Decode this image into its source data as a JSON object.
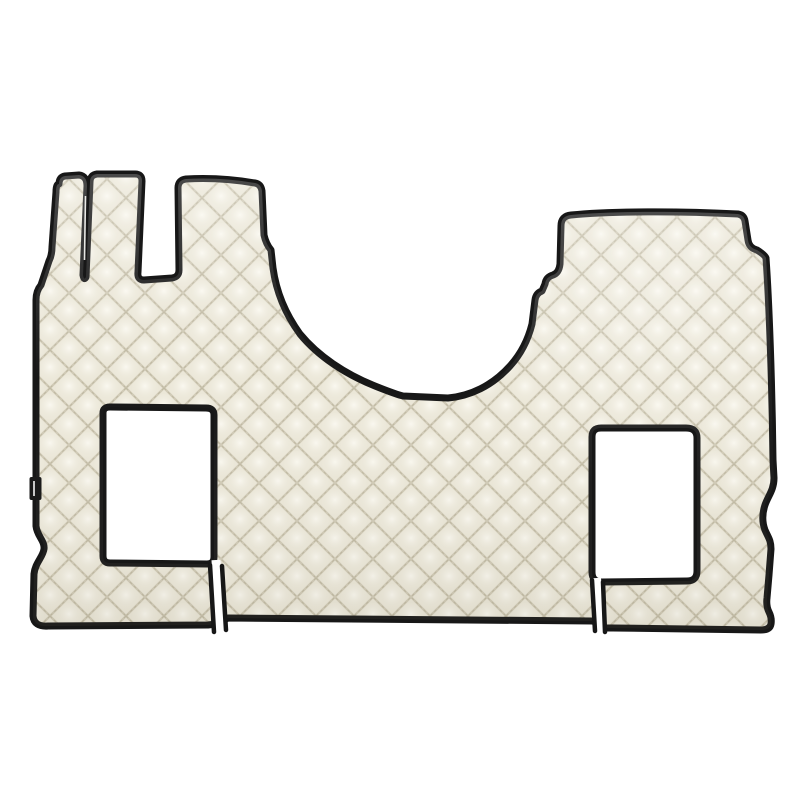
{
  "meta": {
    "title": "Product photo: diamond-quilted eco-leather truck cab floor mat"
  },
  "product": {
    "kind": "truck-cab-floor-mat",
    "finish": "diamond-quilted eco-leather",
    "mat_color_name": "ivory / champagne",
    "trim_color_name": "black piping",
    "features": [
      "three finger-shaped extensions at top left",
      "large U-shaped engine-tunnel notch at top center",
      "raised rectangular section at top right",
      "left seat-base cutout with slit to bottom edge",
      "right seat-base cutout with slit to bottom edge",
      "small black brand tag on left edge (text illegible)"
    ]
  },
  "colors": {
    "background": "#ffffff",
    "mat_base": "#ebe7d8",
    "mat_highlight": "#fbf9f1",
    "mat_midtone": "#f1eee2",
    "mat_seam": "#d0cab6",
    "mat_stitch": "#b7b098",
    "sheen_top": "#ffffff",
    "sheen_bottom": "#7c7560",
    "piping": "#171717",
    "slit_gap": "#ffffff",
    "slit_sliver": "#fdfdf9",
    "tag_black": "#1b1b1b",
    "tag_mark": "#e8e8e8"
  }
}
